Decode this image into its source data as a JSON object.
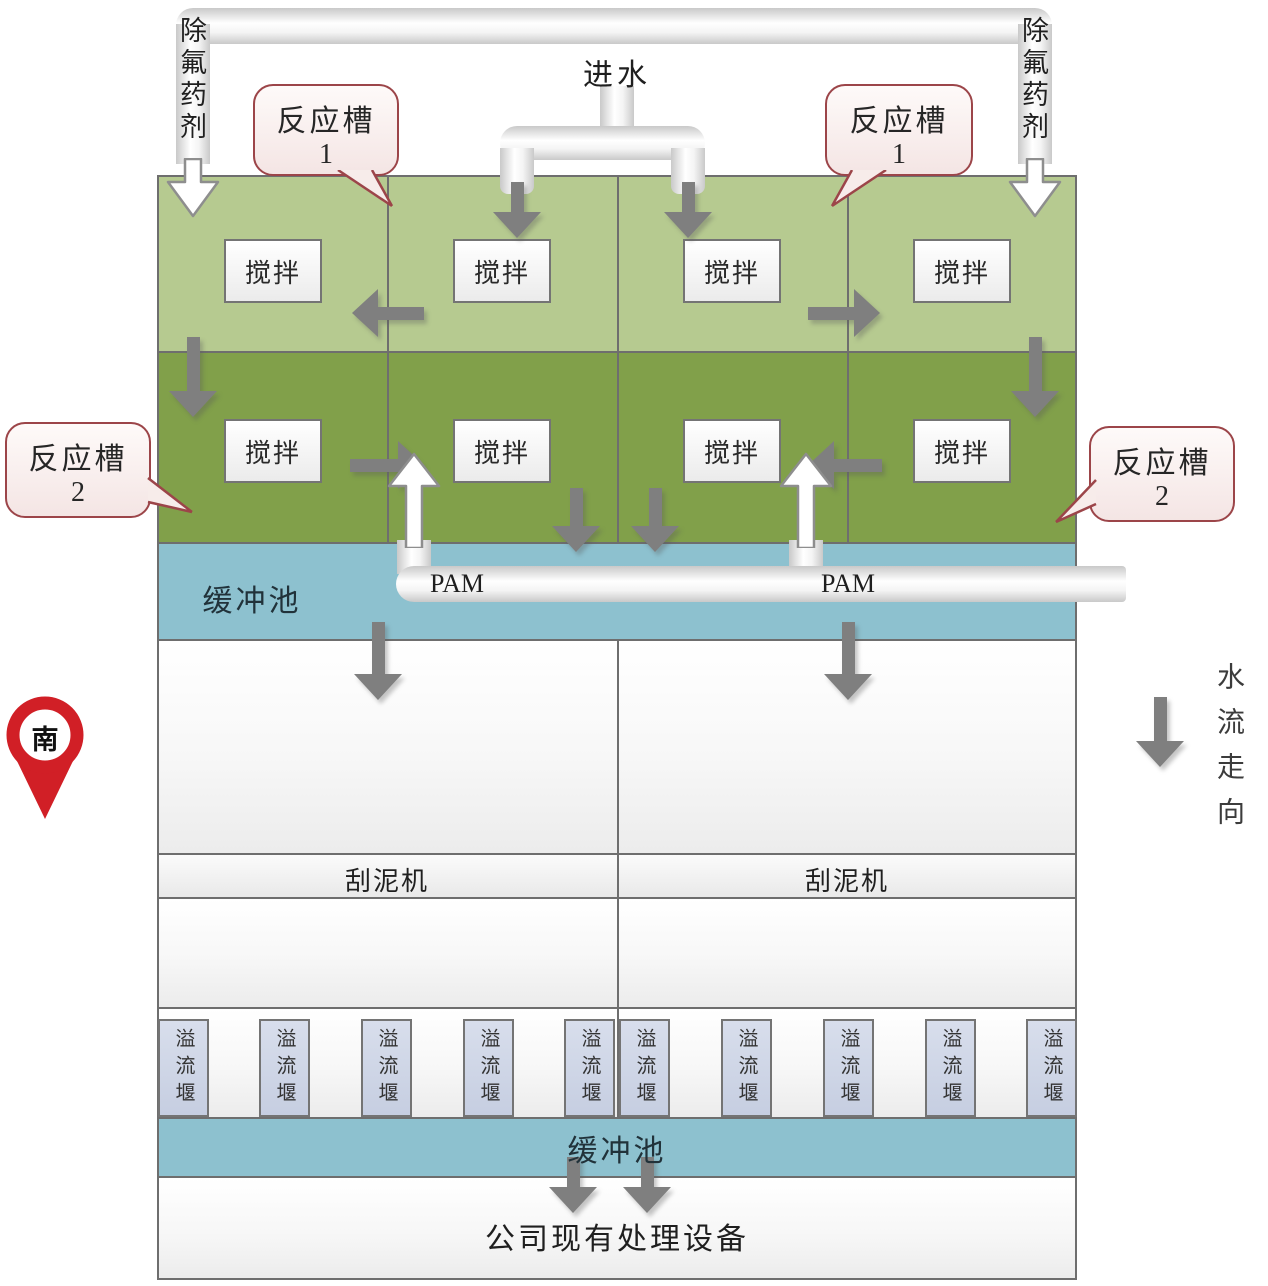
{
  "colors": {
    "reaction_row1_green": "#b6ca90",
    "reaction_row2_green": "#81a04a",
    "buffer_blue": "#8dc1cf",
    "weir_fill": "#ccd4e6",
    "callout_border": "#9c4549",
    "pin_red": "#d11f26",
    "arrow_gray": "#7f7f7f"
  },
  "top": {
    "inlet_label": "进水",
    "chem_left_label": "除氟药剂",
    "chem_right_label": "除氟药剂"
  },
  "callouts": {
    "top_left": {
      "label": "反应槽",
      "number": "1"
    },
    "top_right": {
      "label": "反应槽",
      "number": "1"
    },
    "mid_left": {
      "label": "反应槽",
      "number": "2"
    },
    "mid_right": {
      "label": "反应槽",
      "number": "2"
    }
  },
  "reaction_tanks": {
    "stir_label": "搅拌"
  },
  "buffer_pool_top": {
    "label": "缓冲池"
  },
  "pam": {
    "left_label": "PAM",
    "right_label": "PAM"
  },
  "sedimentation": {
    "scraper_left_label": "刮泥机",
    "scraper_right_label": "刮泥机"
  },
  "weirs": {
    "label": "溢流堰"
  },
  "buffer_pool_bottom": {
    "label": "缓冲池"
  },
  "outlet": {
    "label": "公司现有处理设备"
  },
  "compass": {
    "label": "南"
  },
  "flow_legend": {
    "label": "水流走向"
  }
}
